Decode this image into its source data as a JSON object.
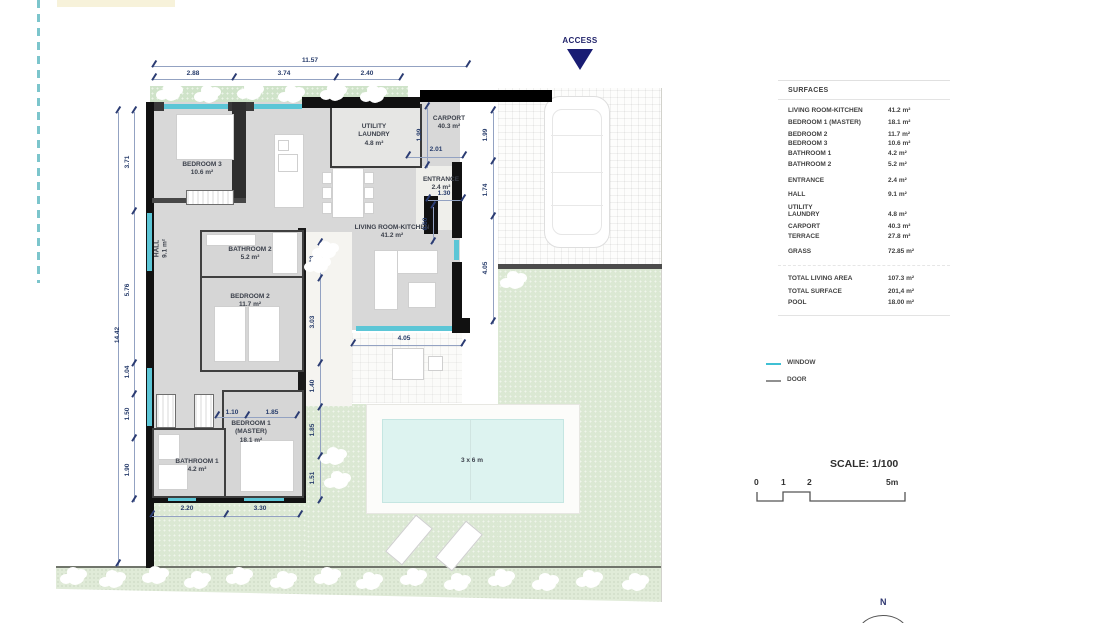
{
  "access": {
    "label": "ACCESS"
  },
  "north": {
    "label": "N"
  },
  "plan": {
    "rooms": {
      "bedroom3": "BEDROOM 3\n10.6 m²",
      "utility": "UTILITY\nLAUNDRY\n4.8 m²",
      "carport": "CARPORT\n40.3 m²",
      "entrance": "ENTRANCE\n2.4 m²",
      "living": "LIVING ROOM-KITCHEN\n41.2 m²",
      "hall": "HALL\n9.1 m²",
      "bathroom2": "BATHROOM 2\n5.2 m²",
      "bedroom2": "BEDROOM 2\n11.7 m²",
      "bedroom1": "BEDROOM 1\n(MASTER)\n18.1 m²",
      "bathroom1": "BATHROOM 1\n4.2 m²",
      "pool": "3 x 6 m"
    },
    "dims": {
      "top_total": "11.57",
      "top_1": "2.88",
      "top_2": "3.74",
      "top_3": "2.40",
      "left_total": "14.42",
      "left_1": "3.71",
      "left_2": "5.76",
      "left_3": "1.04",
      "left_4": "1.50",
      "left_5": "1.90",
      "right_199": "1.99",
      "right_174": "1.74",
      "right_405": "4.05",
      "ent_199": "1.99",
      "ent_201": "2.01",
      "ent_130": "1.30",
      "ent_060": "0.60",
      "living_405": "4.05",
      "in_133": "1.33",
      "in_303": "3.03",
      "in_140": "1.40",
      "in_185": "1.85",
      "in_151": "1.51",
      "b1_110": "1.10",
      "b1_185": "1.85",
      "bot_220": "2.20",
      "bot_330": "3.30"
    }
  },
  "surfaces": {
    "title": "SURFACES",
    "rows": [
      {
        "label": "LIVING ROOM-KITCHEN",
        "value": "41.2 m²"
      },
      {
        "label": "BEDROOM 1 (MASTER)",
        "value": "18.1 m²"
      },
      {
        "label": "BEDROOM 2",
        "value": "11.7 m²"
      },
      {
        "label": "BEDROOM 3",
        "value": "10.6 m²"
      },
      {
        "label": "BATHROOM 1",
        "value": "4.2 m²"
      },
      {
        "label": "BATHROOM 2",
        "value": "5.2 m²"
      },
      {
        "label": "ENTRANCE",
        "value": "2.4 m²"
      },
      {
        "label": "HALL",
        "value": "9.1 m²"
      },
      {
        "label": "UTILITY\nLAUNDRY",
        "value": "4.8 m²"
      },
      {
        "label": "CARPORT",
        "value": "40.3 m²"
      },
      {
        "label": "TERRACE",
        "value": "27.8 m²"
      },
      {
        "label": "GRASS",
        "value": "72.85 m²"
      }
    ],
    "totals": [
      {
        "label": "TOTAL LIVING AREA",
        "value": "107.3 m²"
      },
      {
        "label": "TOTAL SURFACE",
        "value": "201,4 m²"
      },
      {
        "label": "POOL",
        "value": "18.00 m²"
      }
    ]
  },
  "legend": {
    "window": "WINDOW",
    "door": "DOOR"
  },
  "scale": {
    "title": "SCALE: 1/100",
    "t0": "0",
    "t1": "1",
    "t2": "2",
    "t5": "5m"
  },
  "colors": {
    "window_accent": "#5cc6d6",
    "dimension_navy": "#273c6b",
    "access_navy": "#191c73",
    "pool_water": "#ddf3f0",
    "grass_green": "#dbe8d3",
    "wall_black": "#111111"
  }
}
